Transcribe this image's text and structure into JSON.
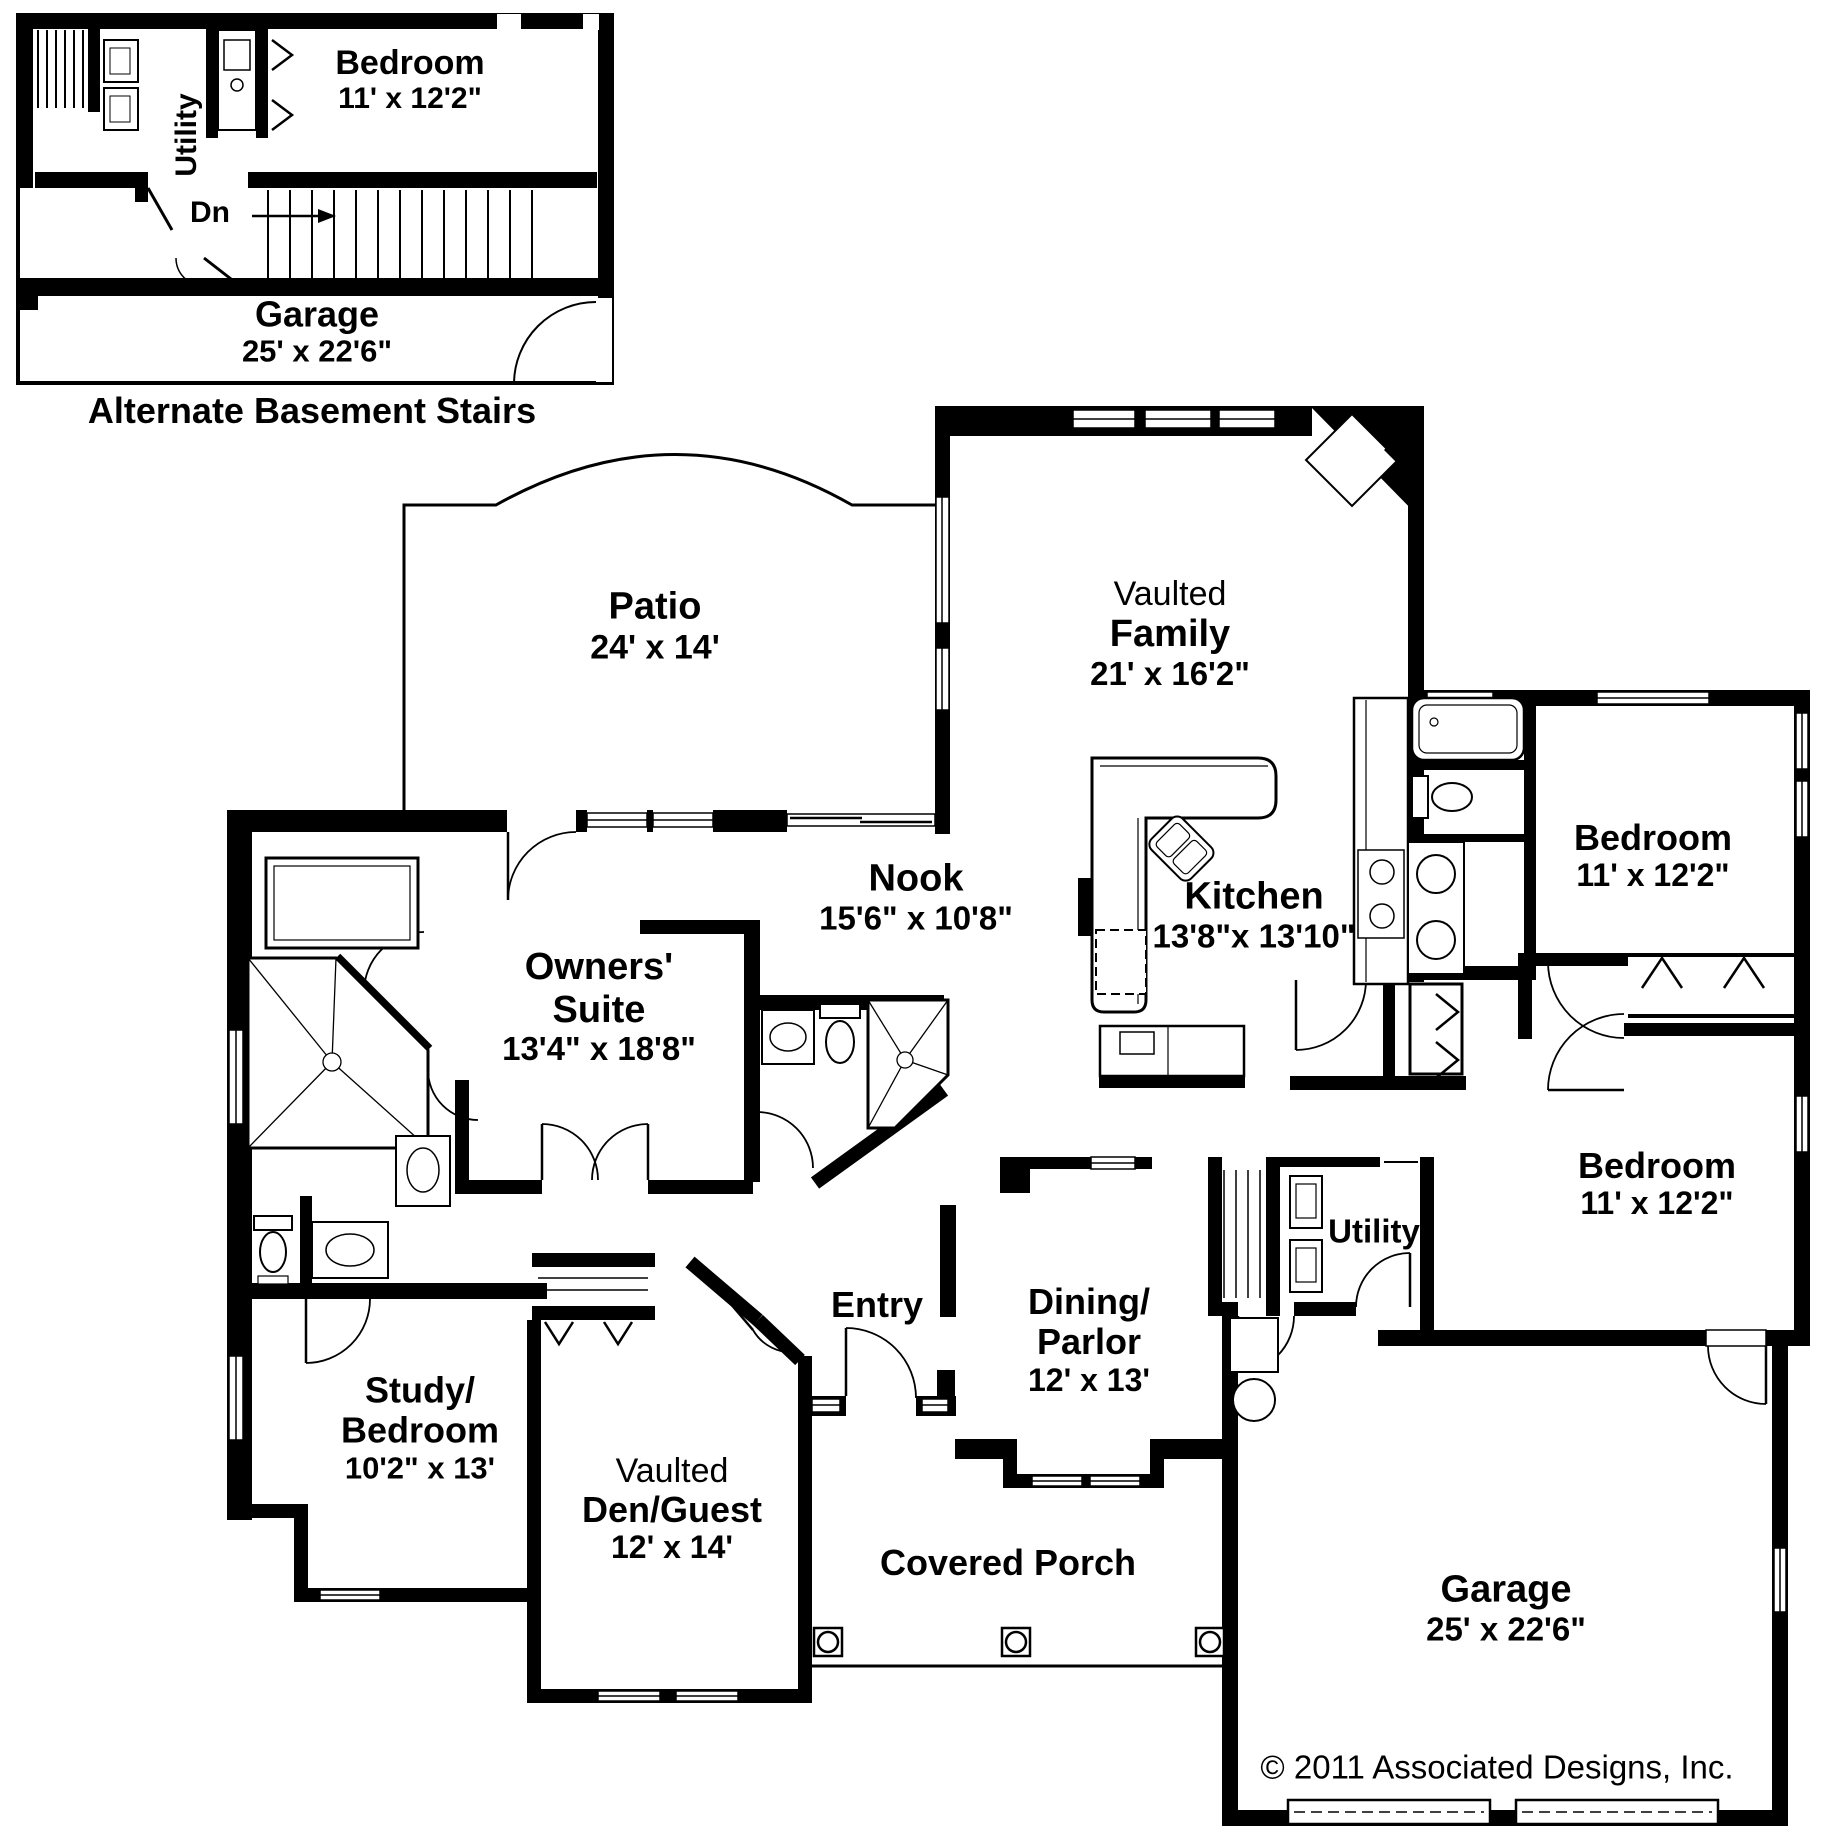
{
  "inset": {
    "title": "Alternate Basement Stairs",
    "utility_label": "Utility",
    "bedroom_name": "Bedroom",
    "bedroom_dims": "11' x 12'2\"",
    "stairs_label": "Dn",
    "garage_name": "Garage",
    "garage_dims": "25' x 22'6\""
  },
  "rooms": {
    "patio": {
      "name": "Patio",
      "dims": "24' x 14'"
    },
    "family": {
      "prefix": "Vaulted",
      "name": "Family",
      "dims": "21' x 16'2\""
    },
    "nook": {
      "name": "Nook",
      "dims": "15'6\" x 10'8\""
    },
    "kitchen": {
      "name": "Kitchen",
      "dims": "13'8\"x 13'10\""
    },
    "bedroom_ne": {
      "name": "Bedroom",
      "dims": "11' x 12'2\""
    },
    "owners_suite": {
      "line1": "Owners'",
      "line2": "Suite",
      "dims": "13'4\" x 18'8\""
    },
    "bedroom_e": {
      "name": "Bedroom",
      "dims": "11' x 12'2\""
    },
    "utility": {
      "name": "Utility"
    },
    "entry": {
      "name": "Entry"
    },
    "dining": {
      "line1": "Dining/",
      "line2": "Parlor",
      "dims": "12' x 13'"
    },
    "study": {
      "line1": "Study/",
      "line2": "Bedroom",
      "dims": "10'2\" x 13'"
    },
    "den": {
      "prefix": "Vaulted",
      "name": "Den/Guest",
      "dims": "12' x 14'"
    },
    "porch": {
      "name": "Covered Porch"
    },
    "garage": {
      "name": "Garage",
      "dims": "25' x 22'6\""
    }
  },
  "copyright": "© 2011 Associated Designs, Inc."
}
